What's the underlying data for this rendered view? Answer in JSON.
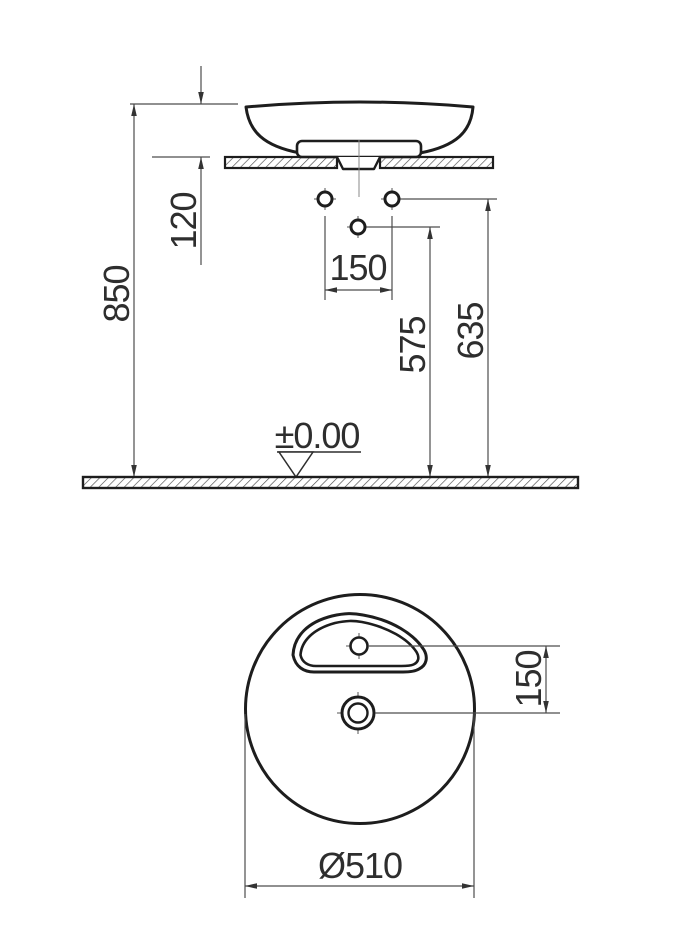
{
  "drawing": {
    "side_view": {
      "total_height": "850",
      "basin_height": "120",
      "hole_spacing": "150",
      "drain_outlet_height": "575",
      "supply_height": "635",
      "floor_datum": "±0.00"
    },
    "plan_view": {
      "tap_to_drain_offset": "150",
      "diameter": "Ø510"
    },
    "colors": {
      "outline": "#1d1d1d",
      "dimension_line": "#4d4d4d",
      "text": "#2e2e2e",
      "background": "#ffffff"
    }
  }
}
